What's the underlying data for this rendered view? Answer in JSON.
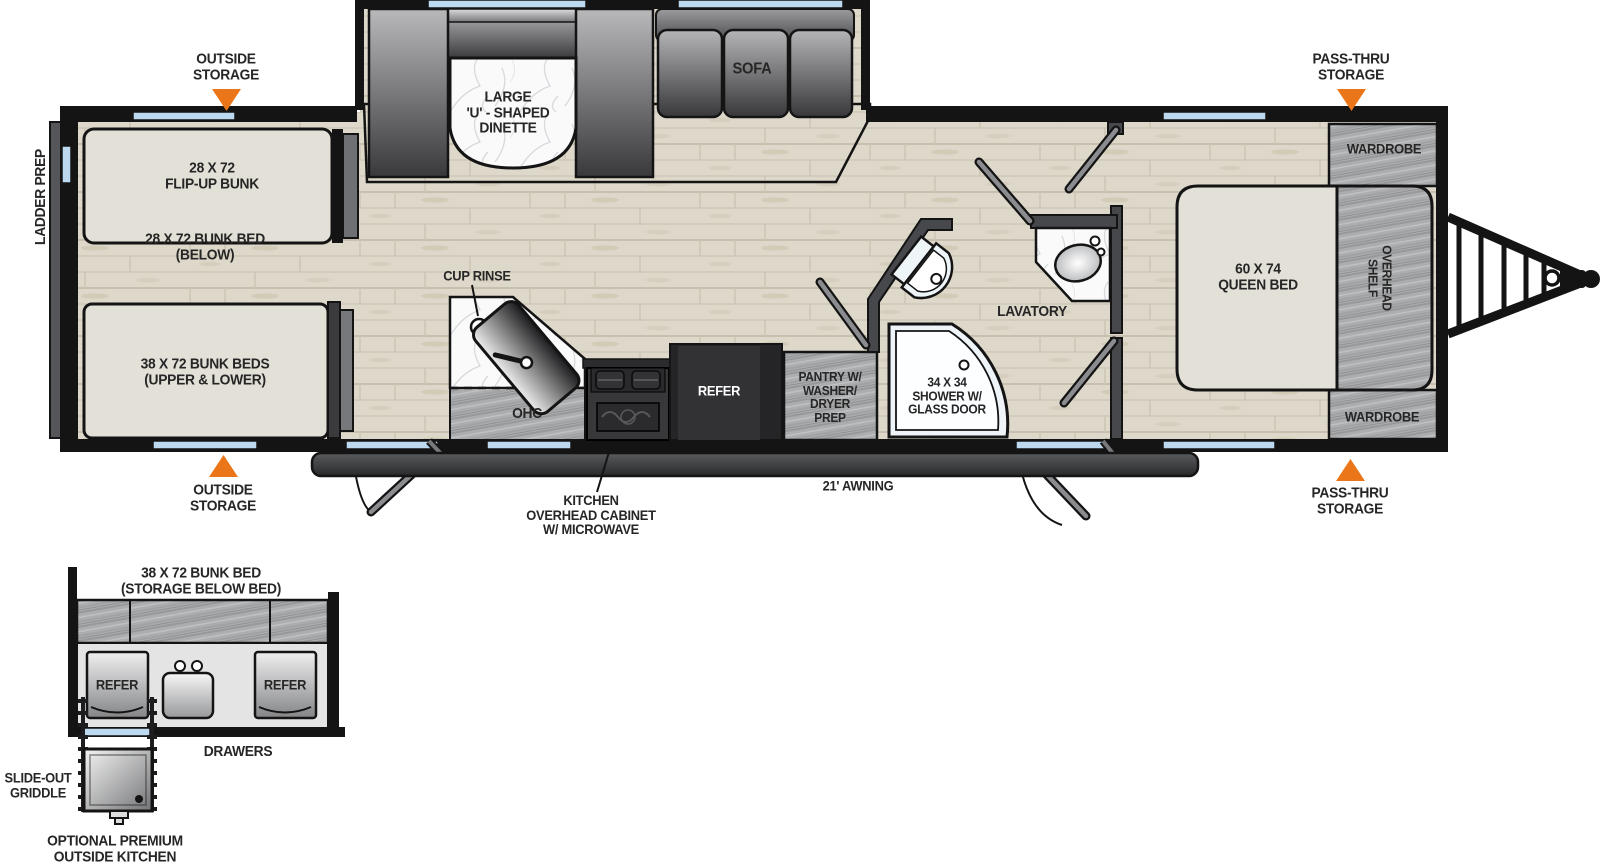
{
  "floorplan": {
    "callouts": {
      "outside_storage_top": "OUTSIDE\nSTORAGE",
      "pass_thru_storage_top": "PASS-THRU\nSTORAGE",
      "outside_storage_bottom": "OUTSIDE\nSTORAGE",
      "pass_thru_storage_bottom": "PASS-THRU\nSTORAGE",
      "ladder_prep": "LADDER PREP",
      "cup_rinse": "CUP RINSE",
      "kitchen_overhead_cabinet": "KITCHEN\nOVERHEAD CABINET\nW/ MICROWAVE",
      "awning": "21' AWNING"
    },
    "rooms": {
      "flip_up_bunk": "28 X 72\nFLIP-UP BUNK",
      "bunk_bed_below": "28 X 72 BUNK BED\n(BELOW)",
      "bunk_beds_upper_lower": "38 X 72 BUNK BEDS\n(UPPER & LOWER)",
      "dinette": "LARGE\n'U' - SHAPED\nDINETTE",
      "sofa": "SOFA",
      "ohc": "OHC",
      "refer": "REFER",
      "pantry": "PANTRY W/\nWASHER/\nDRYER\nPREP",
      "shower": "34 X 34\nSHOWER W/\nGLASS DOOR",
      "lavatory": "LAVATORY",
      "queen_bed": "60 X 74\nQUEEN BED",
      "overhead_shelf": "OVERHEAD\nSHELF",
      "wardrobe_top": "WARDROBE",
      "wardrobe_bottom": "WARDROBE"
    },
    "outside_kitchen": {
      "title": "38 X 72 BUNK BED\n(STORAGE BELOW BED)",
      "refer_left": "REFER",
      "refer_right": "REFER",
      "drawers": "DRAWERS",
      "slide_out_griddle": "SLIDE-OUT\nGRIDDLE",
      "caption": "OPTIONAL PREMIUM\nOUTSIDE KITCHEN"
    },
    "colors": {
      "accent_orange": "#ea7619",
      "wall_black": "#141414",
      "window_blue": "#bcd9ef",
      "floor_wood": "#ded8ca",
      "cabinet_gray": "#acadaf"
    }
  }
}
